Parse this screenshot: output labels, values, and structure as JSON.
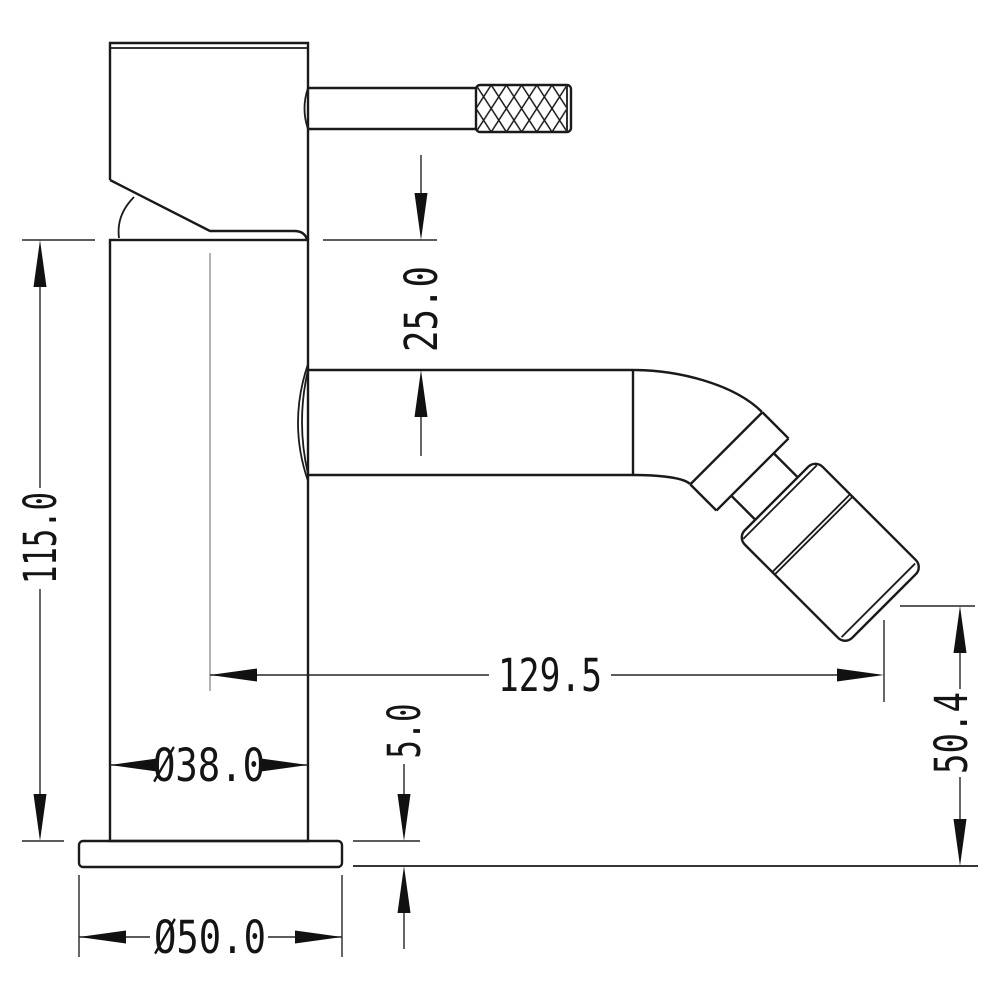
{
  "drawing": {
    "description": "Technical line drawing, side elevation of a single-lever mixer tap with 45-degree angled spout head",
    "colors": {
      "line": "#1a1a1a",
      "dimension_line": "#262626",
      "background": "#ffffff",
      "centerline": "#8a8a8a"
    },
    "dims": {
      "overall_height": "115.0",
      "handle_to_spout_drop": "25.0",
      "spout_reach": "129.5",
      "outlet_height": "50.4",
      "base_plate_thickness": "5.0",
      "body_diameter": "Ø38.0",
      "base_diameter": "Ø50.0"
    }
  }
}
